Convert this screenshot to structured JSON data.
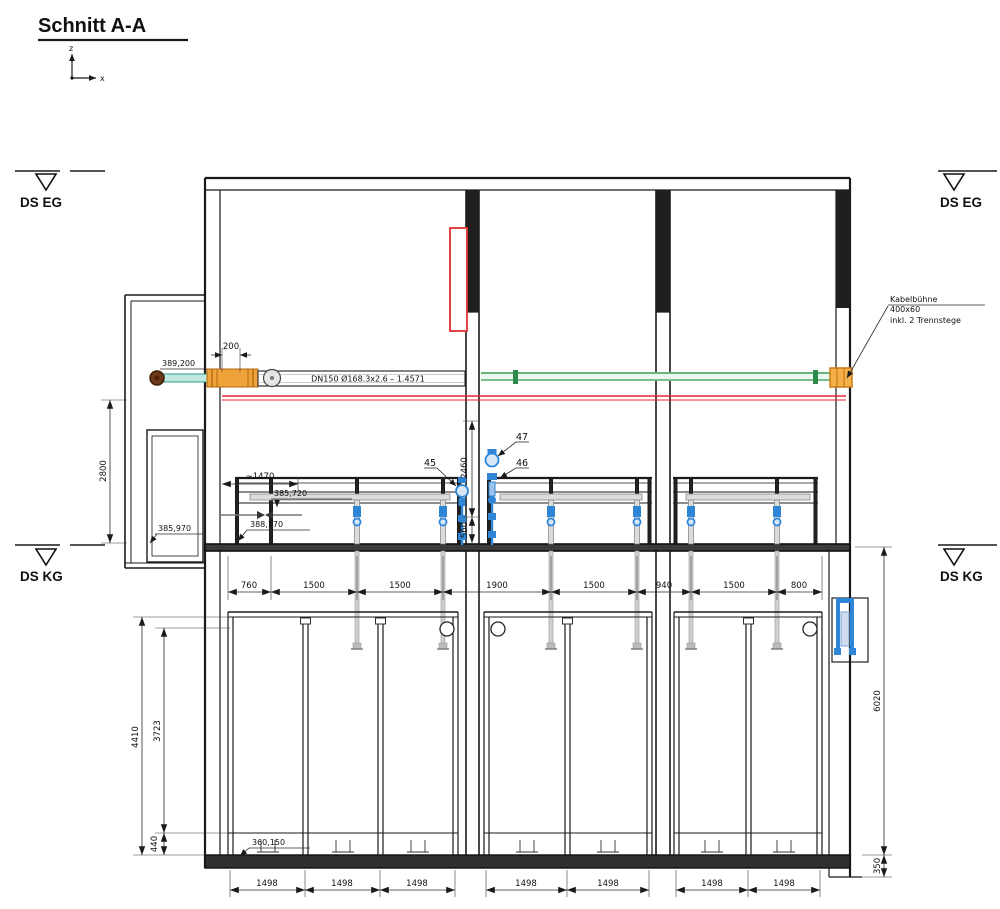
{
  "title": "Schnitt A-A",
  "axis": {
    "z": "z",
    "x": "x"
  },
  "levels": {
    "eg_left": "DS EG",
    "eg_right": "DS EG",
    "kg_left": "DS KG",
    "kg_right": "DS KG"
  },
  "pipe": {
    "spec": "DN150 Ø168.3x2.6 – 1.4571",
    "elevation": "389,200"
  },
  "cable_tray": {
    "name": "Kabelbühne",
    "size": "400x60",
    "note": "inkl. 2 Trennstege"
  },
  "callouts": {
    "c45": "45",
    "c46": "46",
    "c47": "47"
  },
  "elevations": {
    "platform_pipe": "385,720",
    "lower_pipe": "388,170",
    "annex_floor": "385,970",
    "tank_floor": "360,150"
  },
  "vdims": {
    "left_room": "2800",
    "wall_upper": "2460",
    "wall_lower": "560",
    "tank_outer": "4410",
    "tank_inner": "3723",
    "tank_slab": "440",
    "right_total": "6020",
    "right_slab": "350"
  },
  "hdims": {
    "pipe_offset": "200",
    "platform": "~1470",
    "mid": [
      "760",
      "1500",
      "1500",
      "1900",
      "1500",
      "940",
      "1500",
      "800"
    ],
    "bottom": [
      "1498",
      "1498",
      "1498",
      "1498",
      "1498",
      "1498",
      "1498"
    ]
  },
  "colors": {
    "red": "#e8323c",
    "green": "#3a9e55",
    "teal": "#4db8a8",
    "orange": "#f0a23a",
    "blue": "#2f86d6",
    "brown": "#6d3a17"
  }
}
